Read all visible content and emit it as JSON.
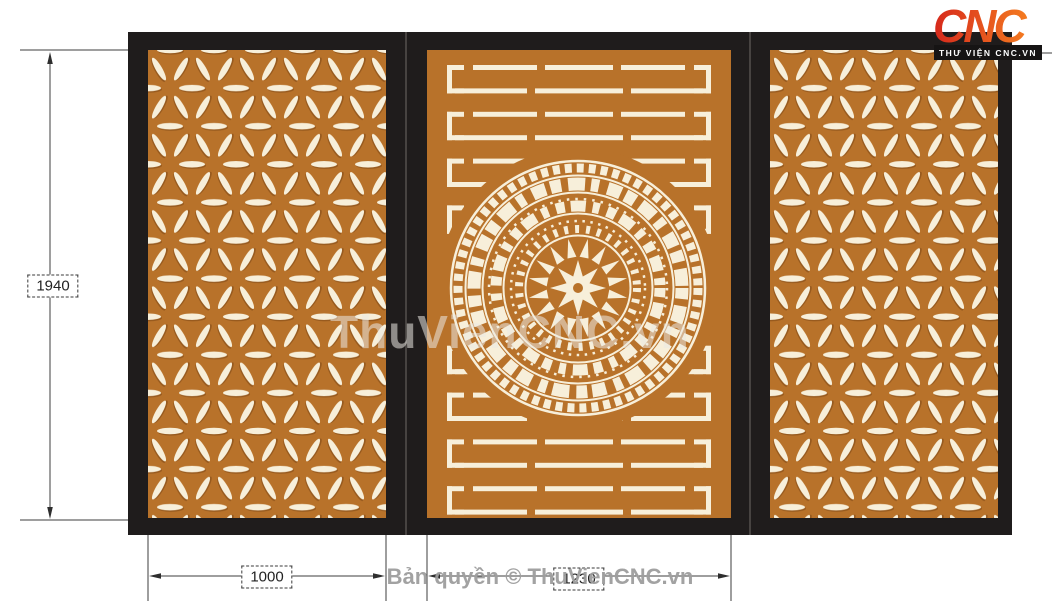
{
  "logo": {
    "text": "CNC",
    "tagline": "THƯ VIỆN CNC.VN"
  },
  "watermark": {
    "main": "ThuVienCNC.vn"
  },
  "footer": {
    "copyright": "Bản quyền © ThuVienCNC.vn"
  },
  "dimensions": {
    "height_label": "1940",
    "left_panel_width_label": "1000",
    "center_panel_width_label": "1230"
  },
  "design": {
    "description": "Three-panel CNC gate: left and right panels with six-petal star lattice pattern, center panel with horizontal slats and Dong Son bronze drum medallion",
    "panels": [
      {
        "name": "left-star-panel",
        "pattern": "star-lattice"
      },
      {
        "name": "center-drum-panel",
        "pattern": "slats-with-dongson-drum"
      },
      {
        "name": "right-star-panel",
        "pattern": "star-lattice"
      }
    ]
  },
  "colors": {
    "panel_orange": "#b8722a",
    "pattern_cream": "#f7efda",
    "frame_black": "#1f1c1c",
    "logo_gradient_start": "#d6281c",
    "logo_gradient_end": "#f47b20"
  }
}
